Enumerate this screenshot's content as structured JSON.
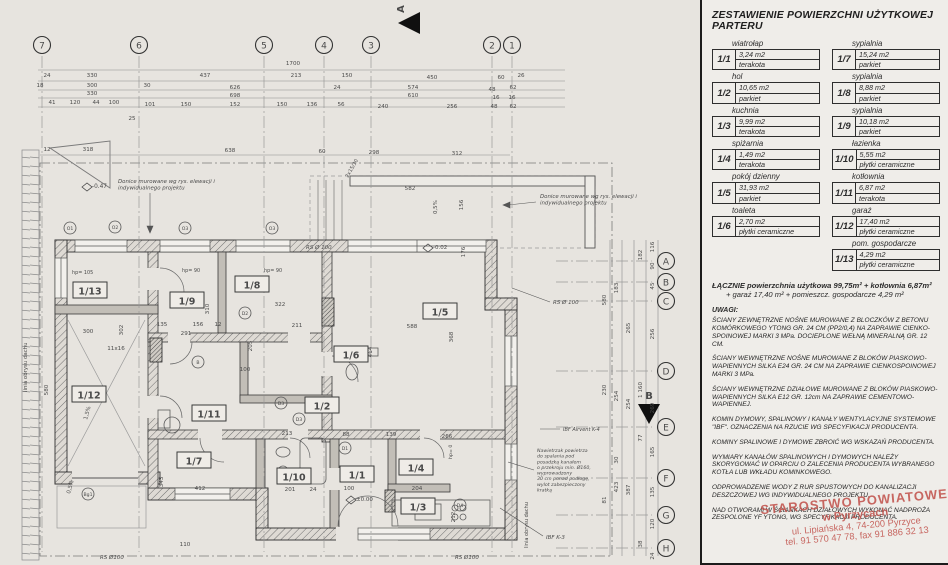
{
  "panel": {
    "title": "ZESTAWIENIE POWIERZCHNI UŻYTKOWEJ PARTERU",
    "rooms": [
      {
        "id": "1/1",
        "name": "wiatrołap",
        "area": "3,24 m2",
        "floor": "terakota"
      },
      {
        "id": "1/2",
        "name": "hol",
        "area": "10,65 m2",
        "floor": "parkiet"
      },
      {
        "id": "1/3",
        "name": "kuchnia",
        "area": "9,99 m2",
        "floor": "terakota"
      },
      {
        "id": "1/4",
        "name": "spiżarnia",
        "area": "1,49 m2",
        "floor": "terakota"
      },
      {
        "id": "1/5",
        "name": "pokój dzienny",
        "area": "31,93 m2",
        "floor": "parkiet"
      },
      {
        "id": "1/6",
        "name": "toaleta",
        "area": "2,70 m2",
        "floor": "płytki ceramiczne"
      },
      {
        "id": "1/7",
        "name": "sypialnia",
        "area": "15,24 m2",
        "floor": "parkiet"
      },
      {
        "id": "1/8",
        "name": "sypialnia",
        "area": "8,88 m2",
        "floor": "parkiet"
      },
      {
        "id": "1/9",
        "name": "sypialnia",
        "area": "10,18 m2",
        "floor": "parkiet"
      },
      {
        "id": "1/10",
        "name": "łazienka",
        "area": "5,55 m2",
        "floor": "płytki ceramiczne"
      },
      {
        "id": "1/11",
        "name": "kotłownia",
        "area": "6,87 m2",
        "floor": "terakota"
      },
      {
        "id": "1/12",
        "name": "garaż",
        "area": "17,40 m2",
        "floor": "płytki ceramiczne"
      },
      {
        "id": "1/13",
        "name": "pom. gospodarcze",
        "area": "4,29 m2",
        "floor": "płytki ceramiczne"
      }
    ],
    "summary_line1": "ŁĄCZNIE powierzchnia użytkowa 99,75m² + kotłownia 6,87m²",
    "summary_line2": "+ garaż 17,40 m² + pomieszcz. gospodarcze 4,29 m²",
    "notes_header": "UWAGI:",
    "notes": [
      "ŚCIANY ZEWNĘTRZNE NOŚNE MUROWANE Z BLOCZKÓW Z BETONU KOMÓRKOWEGO YTONG GR. 24 CM (PP2/0,4) NA ZAPRAWIE CIENKO­SPOINOWEJ MARKI 3 MPa. DOCIEPLONE WEŁNĄ MINERALNĄ GR. 12 CM.",
      "ŚCIANY WEWNĘTRZNE NOŚNE MUROWANE Z BLOKÓW PIASKOWO-WAPIENNYCH SILKA E24 GR. 24 CM NA ZAPRAWIE CIENKOSPOINOWEJ MARKI 3 MPa.",
      "ŚCIANY WEWNĘTRZNE DZIAŁOWE MUROWANE Z BLOKÓW PIASKOWO-WAPIENNYCH SILKA E12 GR. 12cm NA ZAPRAWIE CEMENTOWO-WAPIENNEJ.",
      "KOMIN DYMOWY, SPALINOWY I KANAŁY WENTYLACYJNE SYSTEMOWE \"IBF\". OZNACZENIA NA RZUCIE WG SPECYFIKACJI PRODUCENTA.",
      "KOMINY SPALINOWE I DYMOWE ZBROIĆ WG WSKAZAŃ PRODUCENTA.",
      "WYMIARY KANAŁÓW SPALINOWYCH I DYMOWYCH NALEŻY SKORYGOWAĆ W OPARCIU O ZALECENIA PRODUCENTA WYBRANEGO KOTŁA LUB WKŁADU KOMINKOWEGO.",
      "ODPROWADZENIE WODY Z RUR SPUSTOWYCH DO KANALIZACJI DESZCZOWEJ WG INDYWIDUALNEGO PROJEKTU.",
      "NAD OTWORAMI W ŚCIANKACH DZIAŁOWYCH WYKONAĆ NADPROŻA ZESPOLONE YF YTONG, WG SPECYFIKACJI PRODUCENTA."
    ],
    "stamp": {
      "line1": "STAROSTWO POWIATOWE",
      "line2": "w Pyrzycach",
      "line3": "ul. Lipiańska 4, 74-200 Pyrzyce",
      "line4": "tel. 91 570 47 78, fax 91 886 32 13"
    }
  },
  "plan": {
    "grid_cols": [
      {
        "label": "7",
        "x": 42
      },
      {
        "label": "6",
        "x": 139
      },
      {
        "label": "5",
        "x": 264
      },
      {
        "label": "4",
        "x": 324
      },
      {
        "label": "3",
        "x": 371
      },
      {
        "label": "2",
        "x": 492
      },
      {
        "label": "1",
        "x": 512
      }
    ],
    "grid_rows": [
      {
        "label": "A",
        "y": 261
      },
      {
        "label": "B",
        "y": 282
      },
      {
        "label": "C",
        "y": 301
      },
      {
        "label": "D",
        "y": 371
      },
      {
        "label": "E",
        "y": 427
      },
      {
        "label": "F",
        "y": 478
      },
      {
        "label": "G",
        "y": 515
      },
      {
        "label": "H",
        "y": 548
      }
    ],
    "section_markers": [
      {
        "label": "A",
        "x": 404,
        "y": 9,
        "rot": -90
      },
      {
        "label": "B",
        "x": 649,
        "y": 399,
        "rot": 0
      }
    ],
    "room_labels": [
      {
        "id": "1/13",
        "x": 90,
        "y": 291
      },
      {
        "id": "1/9",
        "x": 187,
        "y": 301
      },
      {
        "id": "1/8",
        "x": 252,
        "y": 285
      },
      {
        "id": "1/5",
        "x": 440,
        "y": 312
      },
      {
        "id": "1/6",
        "x": 351,
        "y": 355
      },
      {
        "id": "1/12",
        "x": 89,
        "y": 395
      },
      {
        "id": "1/11",
        "x": 209,
        "y": 414
      },
      {
        "id": "1/2",
        "x": 322,
        "y": 406
      },
      {
        "id": "1/7",
        "x": 194,
        "y": 461
      },
      {
        "id": "1/10",
        "x": 294,
        "y": 477
      },
      {
        "id": "1/1",
        "x": 357,
        "y": 475
      },
      {
        "id": "1/4",
        "x": 416,
        "y": 468
      },
      {
        "id": "1/3",
        "x": 418,
        "y": 507
      }
    ],
    "annotations": [
      {
        "lines": [
          "Donice murowane wg rys. elewacji i",
          "indywidualnego projektu"
        ],
        "x": 118,
        "y": 183,
        "size": 5.4,
        "italic": true
      },
      {
        "lines": [
          "Donice murowane wg rys. elewacji i",
          "indywidualnego projektu"
        ],
        "x": 540,
        "y": 198,
        "size": 5.4,
        "italic": true
      },
      {
        "lines": [
          "linia obrysu dachu"
        ],
        "x": 27,
        "y": 392,
        "size": 5.4,
        "rot": -90
      },
      {
        "lines": [
          "linia obrysu dachu"
        ],
        "x": 528,
        "y": 548,
        "size": 5,
        "rot": -90
      },
      {
        "lines": [
          "RS Ø 100"
        ],
        "x": 306,
        "y": 249,
        "size": 5.5,
        "italic": true
      },
      {
        "lines": [
          "RS Ø 100"
        ],
        "x": 553,
        "y": 304,
        "size": 5.5,
        "italic": true
      },
      {
        "lines": [
          "RS Ø100"
        ],
        "x": 100,
        "y": 559,
        "size": 5.5,
        "italic": true
      },
      {
        "lines": [
          "RS Ø100"
        ],
        "x": 455,
        "y": 559,
        "size": 5.5,
        "italic": true
      },
      {
        "lines": [
          "IBF Airvent K-4"
        ],
        "x": 563,
        "y": 431,
        "size": 5,
        "italic": true
      },
      {
        "lines": [
          "IBF  K-3"
        ],
        "x": 546,
        "y": 539,
        "size": 5.5,
        "italic": true
      },
      {
        "lines": [
          "Nawietrzak powietrza",
          "do spalania pod",
          "posadzką kanałem",
          "o przekroju min. Ø160,",
          "wyprowadzony",
          "30 cm ponad podłogę,",
          "wylot zabezpieczony",
          "kratką"
        ],
        "x": 537,
        "y": 452,
        "size": 4.7,
        "italic": true
      },
      {
        "lines": [
          "-0.47"
        ],
        "x": 92,
        "y": 188,
        "size": 5.8
      },
      {
        "lines": [
          "-0.02"
        ],
        "x": 433,
        "y": 249,
        "size": 5.5
      },
      {
        "lines": [
          "±0.00"
        ],
        "x": 356,
        "y": 501,
        "size": 5.5
      },
      {
        "lines": [
          "0,5%"
        ],
        "x": 437,
        "y": 214,
        "size": 5.4,
        "rot": -90
      },
      {
        "lines": [
          "0,5%"
        ],
        "x": 70,
        "y": 494,
        "size": 5.4,
        "rot": -75
      },
      {
        "lines": [
          "1,5%"
        ],
        "x": 87,
        "y": 420,
        "size": 5.4,
        "rot": -75
      },
      {
        "lines": [
          "2x15/30"
        ],
        "x": 348,
        "y": 178,
        "size": 5,
        "rot": -60
      },
      {
        "lines": [
          "hp= 105"
        ],
        "x": 72,
        "y": 274,
        "size": 4.9
      },
      {
        "lines": [
          "hp= 90"
        ],
        "x": 182,
        "y": 272,
        "size": 4.9
      },
      {
        "lines": [
          "hp= 90"
        ],
        "x": 264,
        "y": 272,
        "size": 4.9
      },
      {
        "lines": [
          "hp= 0"
        ],
        "x": 452,
        "y": 459,
        "size": 4.7,
        "rot": -90
      }
    ],
    "markers": [
      {
        "t": "O1",
        "x": 70,
        "y": 228
      },
      {
        "t": "O2",
        "x": 115,
        "y": 227
      },
      {
        "t": "O3",
        "x": 185,
        "y": 228
      },
      {
        "t": "O3",
        "x": 272,
        "y": 228
      },
      {
        "t": "D2",
        "x": 245,
        "y": 313
      },
      {
        "t": "B",
        "x": 198,
        "y": 362
      },
      {
        "t": "D3",
        "x": 281,
        "y": 403
      },
      {
        "t": "D3",
        "x": 299,
        "y": 419
      },
      {
        "t": "D1",
        "x": 345,
        "y": 448
      },
      {
        "t": "D4",
        "x": 460,
        "y": 505
      },
      {
        "t": "Bg1",
        "x": 88,
        "y": 494
      }
    ],
    "dims": [
      {
        "t": "1700",
        "x": 293,
        "y": 65
      },
      {
        "t": "24",
        "x": 47,
        "y": 77
      },
      {
        "t": "330",
        "x": 92,
        "y": 77
      },
      {
        "t": "437",
        "x": 205,
        "y": 77
      },
      {
        "t": "213",
        "x": 296,
        "y": 77
      },
      {
        "t": "150",
        "x": 347,
        "y": 77
      },
      {
        "t": "450",
        "x": 432,
        "y": 79
      },
      {
        "t": "60",
        "x": 501,
        "y": 79
      },
      {
        "t": "26",
        "x": 521,
        "y": 77
      },
      {
        "t": "18",
        "x": 40,
        "y": 87
      },
      {
        "t": "300",
        "x": 92,
        "y": 87
      },
      {
        "t": "30",
        "x": 147,
        "y": 87
      },
      {
        "t": "626",
        "x": 235,
        "y": 89
      },
      {
        "t": "24",
        "x": 337,
        "y": 89
      },
      {
        "t": "574",
        "x": 413,
        "y": 89
      },
      {
        "t": "48",
        "x": 492,
        "y": 91
      },
      {
        "t": "62",
        "x": 513,
        "y": 89
      },
      {
        "t": "330",
        "x": 92,
        "y": 95
      },
      {
        "t": "698",
        "x": 235,
        "y": 97
      },
      {
        "t": "610",
        "x": 413,
        "y": 97
      },
      {
        "t": "16",
        "x": 496,
        "y": 99
      },
      {
        "t": "16",
        "x": 512,
        "y": 99
      },
      {
        "t": "41",
        "x": 52,
        "y": 104
      },
      {
        "t": "120",
        "x": 75,
        "y": 104
      },
      {
        "t": "44",
        "x": 96,
        "y": 104
      },
      {
        "t": "100",
        "x": 114,
        "y": 104
      },
      {
        "t": "101",
        "x": 150,
        "y": 106
      },
      {
        "t": "150",
        "x": 186,
        "y": 106
      },
      {
        "t": "152",
        "x": 235,
        "y": 106
      },
      {
        "t": "150",
        "x": 282,
        "y": 106
      },
      {
        "t": "136",
        "x": 312,
        "y": 106
      },
      {
        "t": "56",
        "x": 341,
        "y": 106
      },
      {
        "t": "240",
        "x": 383,
        "y": 108
      },
      {
        "t": "256",
        "x": 452,
        "y": 108
      },
      {
        "t": "48",
        "x": 494,
        "y": 108
      },
      {
        "t": "62",
        "x": 513,
        "y": 108
      },
      {
        "t": "25",
        "x": 132,
        "y": 120
      },
      {
        "t": "12",
        "x": 47,
        "y": 151
      },
      {
        "t": "318",
        "x": 88,
        "y": 151
      },
      {
        "t": "638",
        "x": 230,
        "y": 152
      },
      {
        "t": "60",
        "x": 322,
        "y": 153
      },
      {
        "t": "298",
        "x": 374,
        "y": 154
      },
      {
        "t": "312",
        "x": 457,
        "y": 155
      },
      {
        "t": "580",
        "x": 606,
        "y": 300,
        "r": -90
      },
      {
        "t": "230",
        "x": 606,
        "y": 390,
        "r": -90
      },
      {
        "t": "81",
        "x": 606,
        "y": 500,
        "r": -90
      },
      {
        "t": "183",
        "x": 618,
        "y": 288,
        "r": -90
      },
      {
        "t": "254",
        "x": 618,
        "y": 396,
        "r": -90
      },
      {
        "t": "30",
        "x": 618,
        "y": 460,
        "r": -90
      },
      {
        "t": "423",
        "x": 618,
        "y": 487,
        "r": -90
      },
      {
        "t": "265",
        "x": 630,
        "y": 328,
        "r": -90
      },
      {
        "t": "254",
        "x": 630,
        "y": 404,
        "r": -90
      },
      {
        "t": "387",
        "x": 630,
        "y": 490,
        "r": -90
      },
      {
        "t": "182",
        "x": 642,
        "y": 255,
        "r": -90
      },
      {
        "t": "1 160",
        "x": 642,
        "y": 390,
        "r": -90
      },
      {
        "t": "77",
        "x": 642,
        "y": 438,
        "r": -90
      },
      {
        "t": "38",
        "x": 642,
        "y": 544,
        "r": -90
      },
      {
        "t": "116",
        "x": 654,
        "y": 247,
        "r": -90
      },
      {
        "t": "90",
        "x": 654,
        "y": 266,
        "r": -90
      },
      {
        "t": "45",
        "x": 654,
        "y": 286,
        "r": -90
      },
      {
        "t": "256",
        "x": 654,
        "y": 334,
        "r": -90
      },
      {
        "t": "269",
        "x": 654,
        "y": 408,
        "r": -90
      },
      {
        "t": "165",
        "x": 654,
        "y": 452,
        "r": -90
      },
      {
        "t": "135",
        "x": 654,
        "y": 492,
        "r": -90
      },
      {
        "t": "120",
        "x": 654,
        "y": 524,
        "r": -90
      },
      {
        "t": "24",
        "x": 654,
        "y": 556,
        "r": -90
      },
      {
        "t": "580",
        "x": 48,
        "y": 390,
        "r": -90
      },
      {
        "t": "302",
        "x": 123,
        "y": 330,
        "r": -90
      },
      {
        "t": "300",
        "x": 88,
        "y": 333
      },
      {
        "t": "135",
        "x": 162,
        "y": 326
      },
      {
        "t": "156",
        "x": 198,
        "y": 326
      },
      {
        "t": "12",
        "x": 218,
        "y": 326
      },
      {
        "t": "291",
        "x": 186,
        "y": 335
      },
      {
        "t": "310",
        "x": 209,
        "y": 309,
        "r": -90
      },
      {
        "t": "322",
        "x": 280,
        "y": 306
      },
      {
        "t": "211",
        "x": 297,
        "y": 327
      },
      {
        "t": "100",
        "x": 245,
        "y": 371
      },
      {
        "t": "205",
        "x": 252,
        "y": 346,
        "r": -90
      },
      {
        "t": "588",
        "x": 412,
        "y": 328
      },
      {
        "t": "582",
        "x": 410,
        "y": 190
      },
      {
        "t": "368",
        "x": 453,
        "y": 337,
        "r": -90
      },
      {
        "t": "464",
        "x": 372,
        "y": 352,
        "r": -90
      },
      {
        "t": "156",
        "x": 463,
        "y": 205,
        "r": -90
      },
      {
        "t": "176",
        "x": 465,
        "y": 252,
        "r": -90
      },
      {
        "t": "412",
        "x": 200,
        "y": 490
      },
      {
        "t": "343",
        "x": 163,
        "y": 482,
        "r": -90
      },
      {
        "t": "201",
        "x": 290,
        "y": 491
      },
      {
        "t": "24",
        "x": 313,
        "y": 491
      },
      {
        "t": "213",
        "x": 287,
        "y": 435
      },
      {
        "t": "88",
        "x": 346,
        "y": 436
      },
      {
        "t": "139",
        "x": 391,
        "y": 436
      },
      {
        "t": "266",
        "x": 447,
        "y": 438
      },
      {
        "t": "204",
        "x": 417,
        "y": 490
      },
      {
        "t": "100",
        "x": 349,
        "y": 490
      },
      {
        "t": "212",
        "x": 455,
        "y": 517,
        "r": -90
      },
      {
        "t": "110",
        "x": 185,
        "y": 546
      },
      {
        "t": "11x16",
        "x": 116,
        "y": 350
      }
    ]
  }
}
